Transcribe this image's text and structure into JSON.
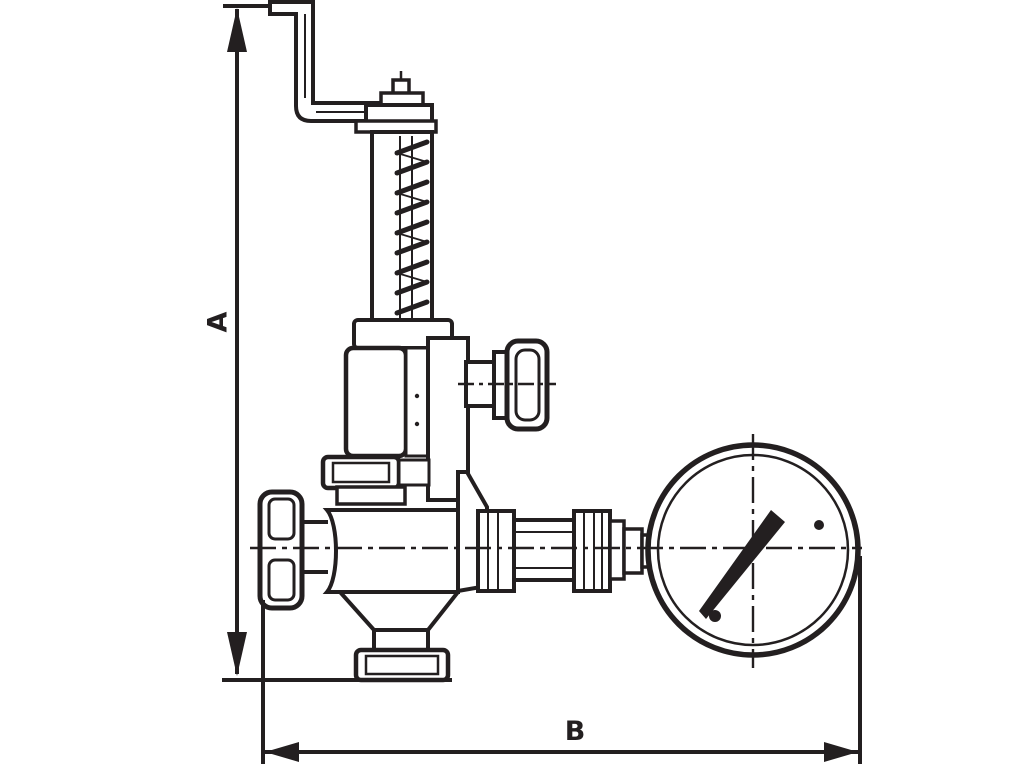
{
  "page": {
    "background_color": "#ffffff",
    "ink_color": "#231f20",
    "kind": "technical line drawing, dimensioned side view"
  },
  "diagram": {
    "subject": "overflow / pressure relief valve with spring bonnet, hand knobs and pressure gauge",
    "dimensions": {
      "height_label": "A",
      "width_label": "B"
    },
    "dimension_lines": [
      {
        "label": "A",
        "orientation": "vertical",
        "side": "left",
        "arrows": "both ends",
        "measures": "overall height from top of bent lever to bottom outlet flange"
      },
      {
        "label": "B",
        "orientation": "horizontal",
        "side": "bottom",
        "arrows": "both ends",
        "measures": "overall width from left handwheel to right edge of gauge"
      }
    ],
    "components": [
      "bent-lever-arm",
      "adjusting-cap",
      "spring-column-with-coil",
      "spring-base-flange",
      "bonnet",
      "side-stem",
      "side-knob",
      "union-flange",
      "valve-body",
      "left-handwheel",
      "bottom-outlet-funnel",
      "bottom-outlet-flange",
      "pipe-fittings",
      "pressure-gauge"
    ],
    "gauge": {
      "shape": "double-rim circle with dashed crosshair centerlines",
      "needle_direction": "pointing upper-right (~1-2 o'clock)",
      "detail_dots": 2
    }
  }
}
